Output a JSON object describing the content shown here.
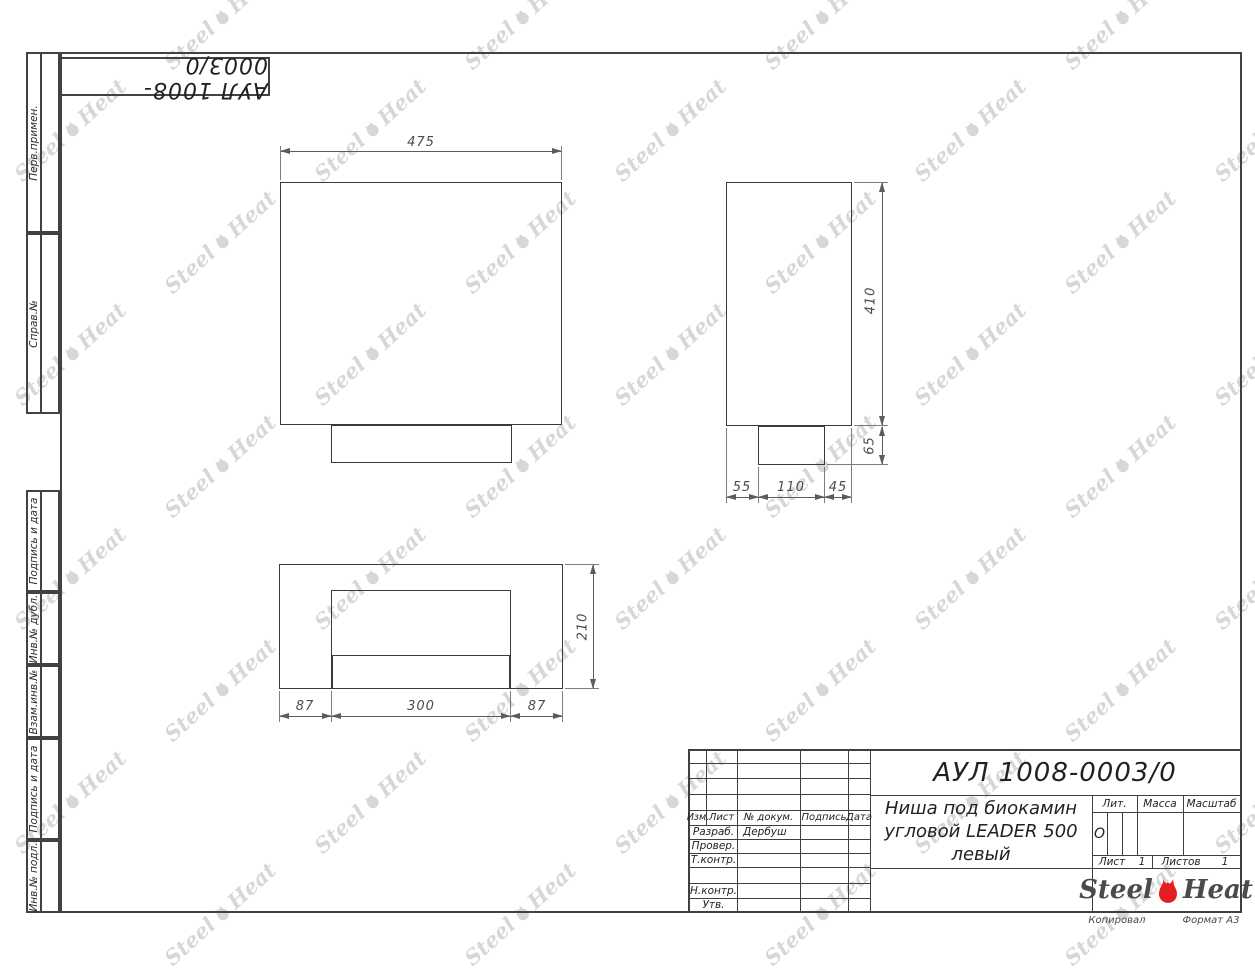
{
  "document": {
    "designation": "АУЛ 1008-0003/0",
    "title_lines": [
      "Ниша под биокамин",
      "угловой LEADER 500",
      "левый"
    ],
    "copied_note": "Копировал",
    "format_note": "Формат А3"
  },
  "stamp_top": {
    "text": "АУЛ 1008-0003/0"
  },
  "sidebar": {
    "items": [
      {
        "label": "Перв.примен."
      },
      {
        "label": "Справ.№"
      },
      {
        "label": "Подпись и дата"
      },
      {
        "label": "Инв.№ дубл."
      },
      {
        "label": "Взам.инв.№"
      },
      {
        "label": "Подпись и дата"
      },
      {
        "label": "Инв.№ подл."
      }
    ]
  },
  "title_block": {
    "header_cols": [
      "Изм.",
      "Лист",
      "№ докум.",
      "Подпись",
      "Дата"
    ],
    "rows": [
      {
        "label": "Разраб.",
        "value": "Дербуш"
      },
      {
        "label": "Провер.",
        "value": ""
      },
      {
        "label": "Т.контр.",
        "value": ""
      },
      {
        "label": "",
        "value": ""
      },
      {
        "label": "Н.контр.",
        "value": ""
      },
      {
        "label": "Утв.",
        "value": ""
      }
    ],
    "lit_label": "Лит.",
    "lit_value": "О",
    "mass_label": "Масса",
    "scale_label": "Масштаб",
    "sheet_label": "Лист",
    "sheet_value": "1",
    "sheets_label": "Листов",
    "sheets_value": "1"
  },
  "brand": {
    "steel": "Steel",
    "heat": "Heat",
    "flame_color": "#e31e24"
  },
  "watermark": {
    "steel": "Steel",
    "heat": "Heat"
  },
  "dims": {
    "front_width": "475",
    "side_height": "410",
    "base_height": "65",
    "side_segments": [
      "55",
      "110",
      "45"
    ],
    "plan_segments": [
      "87",
      "300",
      "87"
    ],
    "plan_depth": "210"
  }
}
